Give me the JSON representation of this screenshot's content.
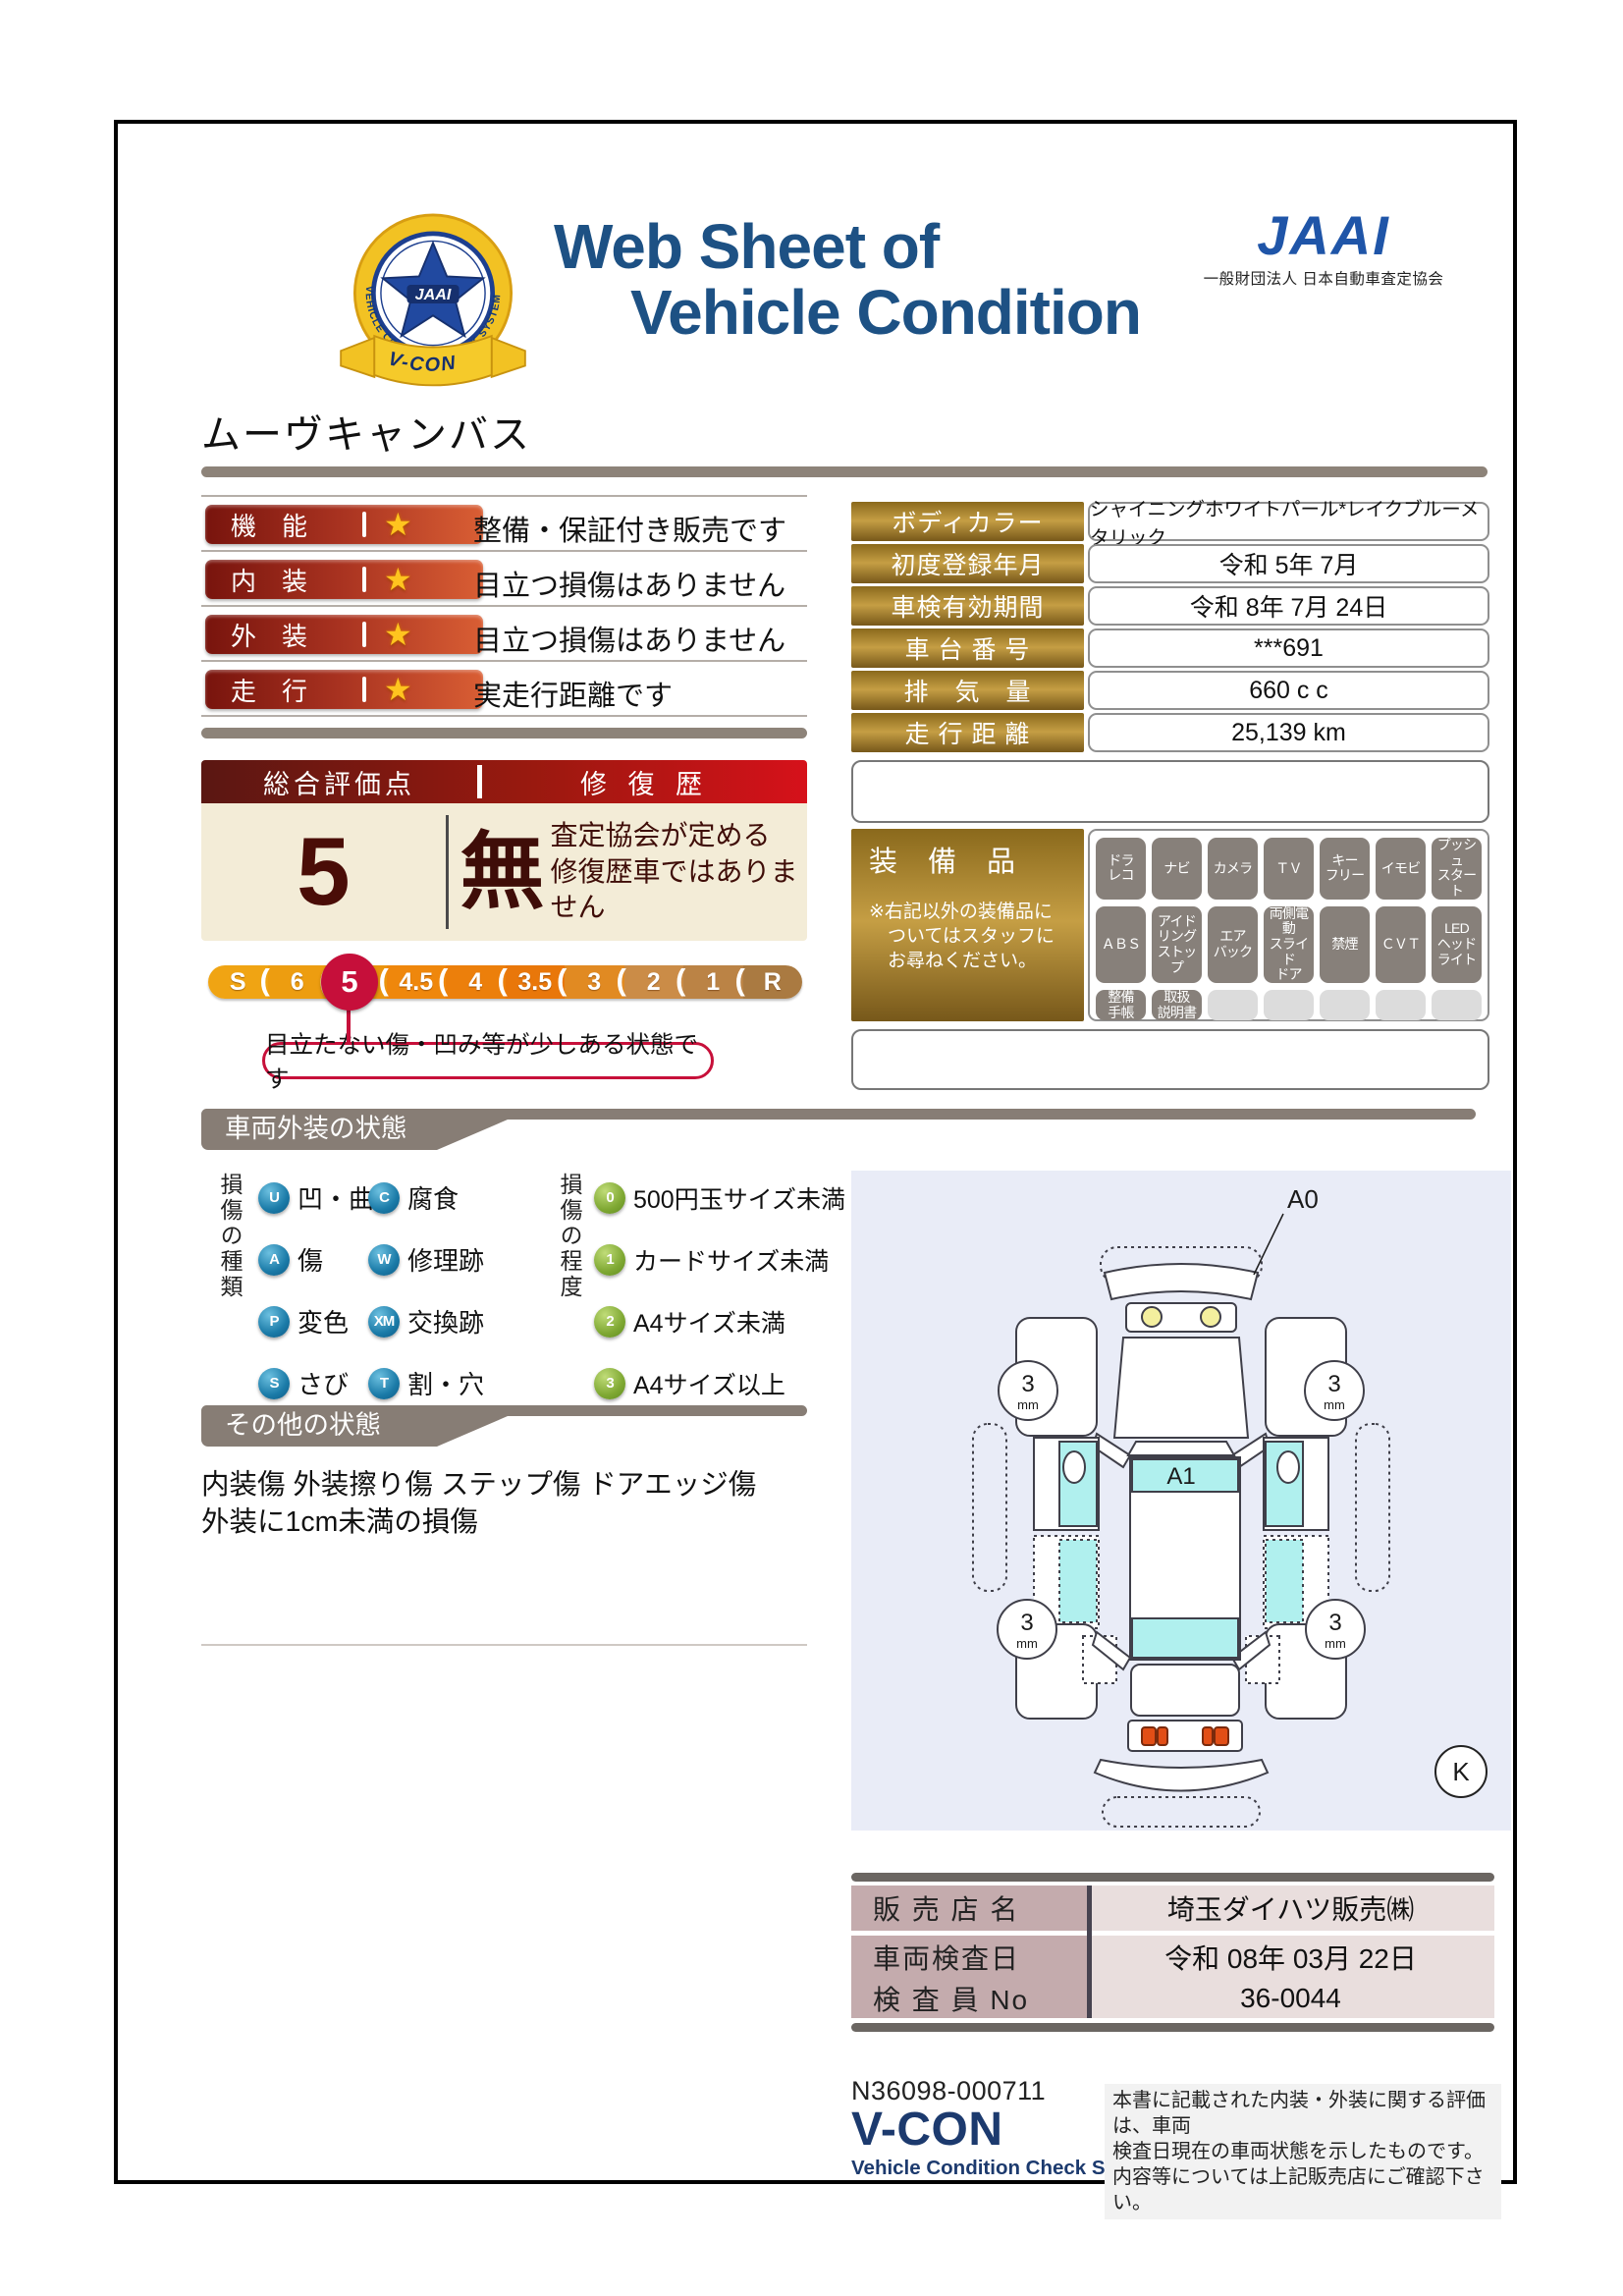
{
  "header": {
    "title_line1": "Web Sheet of",
    "title_line2": "Vehicle Condition",
    "emblem": {
      "ring_text": "VEHICLE CONDITION CHECK SYSTEM",
      "center_text": "JAAI",
      "ribbon_text": "V-CON"
    },
    "org_logo": "JAAI",
    "org_name": "一般財団法人 日本自動車査定協会"
  },
  "vehicle_name": "ムーヴキャンバス",
  "ratings": {
    "rows": [
      {
        "label": "機　能",
        "star": "★",
        "desc": "整備・保証付き販売です"
      },
      {
        "label": "内　装",
        "star": "★",
        "desc": "目立つ損傷はありません"
      },
      {
        "label": "外　装",
        "star": "★",
        "desc": "目立つ損傷はありません"
      },
      {
        "label": "走　行",
        "star": "★",
        "desc": "実走行距離です"
      }
    ]
  },
  "info_table": {
    "rows": [
      {
        "label": "ボディカラー",
        "value": "シャイニングホワイトパール*レイクブルーメタリック"
      },
      {
        "label": "初度登録年月",
        "value": "令和 5年 7月"
      },
      {
        "label": "車検有効期間",
        "value": "令和 8年 7月 24日"
      },
      {
        "label": "車 台 番 号",
        "value": "***691"
      },
      {
        "label": "排　気　量",
        "value": "660 c c"
      },
      {
        "label": "走 行 距 離",
        "value": "25,139 km"
      }
    ]
  },
  "overall": {
    "header_left": "総合評価点",
    "header_right": "修 復 歴",
    "score": "5",
    "repair_flag": "無",
    "repair_note_line1": "査定協会が定める",
    "repair_note_line2": "修復歴車ではありません"
  },
  "scale": {
    "separator": "(",
    "selected": "5",
    "callout": "目立たない傷・凹み等が少しある状態です",
    "segments": [
      {
        "t": "S",
        "c": "#f0a413"
      },
      {
        "t": "6",
        "c": "#ed9d10"
      },
      {
        "t": "5",
        "c": "#ea940e"
      },
      {
        "t": "4.5",
        "c": "#ef870c"
      },
      {
        "t": "4",
        "c": "#ec7f0b"
      },
      {
        "t": "3.5",
        "c": "#e9770a"
      },
      {
        "t": "3",
        "c": "#e18a22"
      },
      {
        "t": "2",
        "c": "#cb8c47"
      },
      {
        "t": "1",
        "c": "#bb8345"
      },
      {
        "t": "R",
        "c": "#aa7a41"
      }
    ]
  },
  "equipment": {
    "title": "装　備　品",
    "note": "※右記以外の装備品に\n　ついてはスタッフに\n　お尋ねください。",
    "items": [
      "ドラ\nレコ",
      "ナビ",
      "カメラ",
      "ＴＶ",
      "キー\nフリー",
      "イモビ",
      "プッシュ\nスタート",
      "ＡＢＳ",
      "アイド\nリング\nストップ",
      "エア\nバック",
      "両側電動\nスライド\nドア",
      "禁煙",
      "ＣＶＴ",
      "LED\nヘッド\nライト",
      "整備\n手帳",
      "取扱\n説明書"
    ],
    "empty_slots": [
      "",
      "",
      "",
      "",
      ""
    ]
  },
  "exterior_section": {
    "title": "車両外装の状態",
    "type_axis": "損傷の種類",
    "types": [
      {
        "code": "U",
        "label": "凹・曲"
      },
      {
        "code": "C",
        "label": "腐食"
      },
      {
        "code": "A",
        "label": "傷"
      },
      {
        "code": "W",
        "label": "修理跡"
      },
      {
        "code": "P",
        "label": "変色"
      },
      {
        "code": "XM",
        "label": "交換跡"
      },
      {
        "code": "S",
        "label": "さび"
      },
      {
        "code": "T",
        "label": "割・穴"
      }
    ],
    "degree_axis": "損傷の程度",
    "degrees": [
      {
        "code": "0",
        "label": "500円玉サイズ未満"
      },
      {
        "code": "1",
        "label": "カードサイズ未満"
      },
      {
        "code": "2",
        "label": "A4サイズ未満"
      },
      {
        "code": "3",
        "label": "A4サイズ以上"
      }
    ]
  },
  "other_section": {
    "title": "その他の状態",
    "line1": "内装傷 外装擦り傷 ステップ傷 ドアエッジ傷",
    "line2": "外装に1cm未満の損傷"
  },
  "diagram": {
    "label_a0": "A0",
    "label_a1": "A1",
    "tire_value": "3",
    "tire_unit": "mm",
    "label_k": "K"
  },
  "dealer": {
    "rows": [
      {
        "label": "販 売 店 名",
        "value": "埼玉ダイハツ販売㈱"
      },
      {
        "label": "車両検査日",
        "value": "令和 08年 03月 22日"
      },
      {
        "label": "検 査 員 No",
        "value": "36-0044"
      }
    ]
  },
  "footer": {
    "doc_number": "N36098-000711",
    "system_name": "V-CON",
    "system_subtitle": "Vehicle Condition Check System",
    "note": "本書に記載された内装・外装に関する評価は、車両\n検査日現在の車両状態を示したものです。\n内容等については上記販売店にご確認下さい。"
  },
  "colors": {
    "accent_red": "#c60f3a",
    "title_blue": "#1d5184",
    "gold": "#b8923a",
    "section_gray": "#877d75"
  }
}
